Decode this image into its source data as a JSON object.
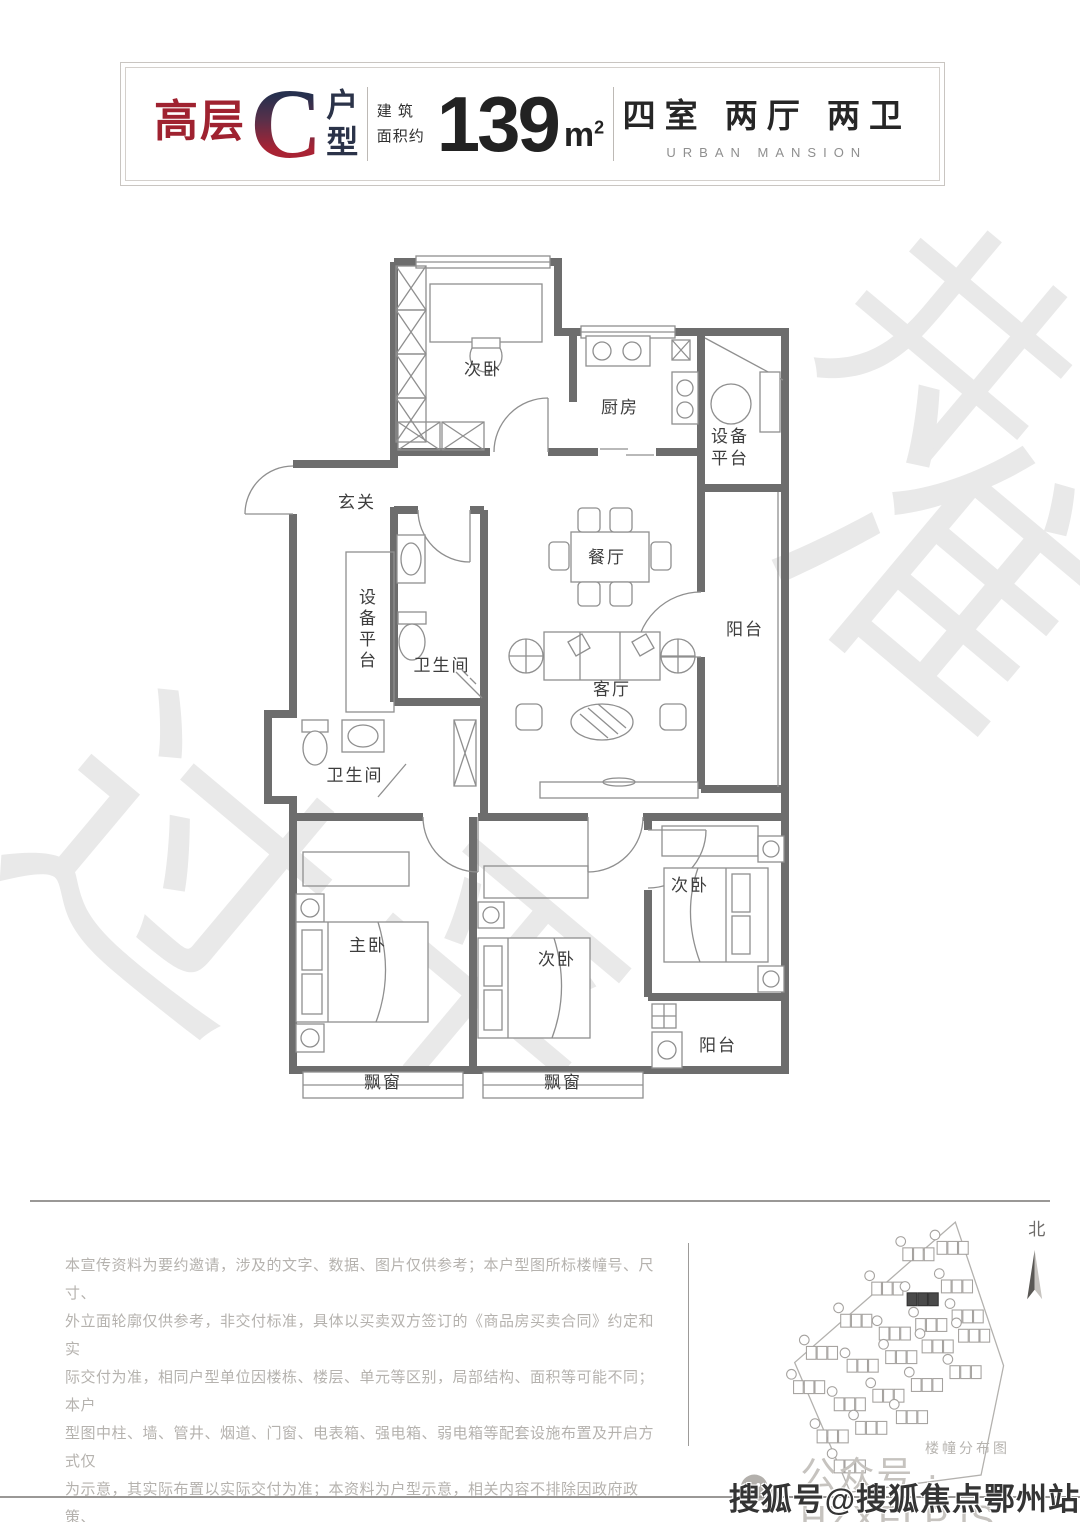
{
  "header": {
    "series": "高层",
    "letter": "C",
    "suffix_top": "户",
    "suffix_bottom": "型",
    "area_label_1": "建 筑",
    "area_label_2": "面积约",
    "area_value": "139",
    "area_unit_base": "m",
    "area_unit_sup": "2",
    "spec": "四室 两厅 两卫",
    "spec_en": "URBAN MANSION"
  },
  "floor_plan": {
    "rooms": [
      {
        "label": "次卧",
        "x": 225,
        "y": 118
      },
      {
        "label": "厨房",
        "x": 362,
        "y": 156
      },
      {
        "label": "设备\n平台",
        "x": 472,
        "y": 196
      },
      {
        "label": "玄关",
        "x": 99,
        "y": 251
      },
      {
        "label": "餐厅",
        "x": 349,
        "y": 306
      },
      {
        "label": "阳台",
        "x": 487,
        "y": 378
      },
      {
        "label": "设备平台",
        "x": 107,
        "y": 378,
        "vertical": true
      },
      {
        "label": "卫生间",
        "x": 184,
        "y": 414
      },
      {
        "label": "客厅",
        "x": 354,
        "y": 438
      },
      {
        "label": "卫生间",
        "x": 97,
        "y": 524
      },
      {
        "label": "主卧",
        "x": 110,
        "y": 694
      },
      {
        "label": "次卧",
        "x": 299,
        "y": 708
      },
      {
        "label": "次卧",
        "x": 432,
        "y": 634
      },
      {
        "label": "阳台",
        "x": 460,
        "y": 794
      },
      {
        "label": "飘窗",
        "x": 125,
        "y": 831
      },
      {
        "label": "飘窗",
        "x": 305,
        "y": 831
      }
    ]
  },
  "disclaimer": {
    "lines": [
      "本宣传资料为要约邀请，涉及的文字、数据、图片仅供参考；本户型图所标楼幢号、尺寸、",
      "外立面轮廓仅供参考，非交付标准，具体以买卖双方签订的《商品房买卖合同》约定和实",
      "际交付为准，相同户型单位因楼栋、楼层、单元等区别，局部结构、面积等可能不同；本户",
      "型图中柱、墙、管井、烟道、门窗、电表箱、强电箱、弱电箱等配套设施布置及开启方式仅",
      "为示意，其实际布置以实际交付为准；本资料为户型示意，相关内容不排除因政府政策、",
      "规定及开发商不可控因素而变化，本公司保留对宣传资料修改的权利，所发布的各项内",
      "容制作时间：2023年7月，有效期1个月。"
    ]
  },
  "site_map": {
    "caption": "楼幢分布图",
    "north_label": "北",
    "polygon": "228,16 273,150 252,252 130,268 78,147",
    "buildings": [
      [
        194,
        46
      ],
      [
        226,
        40
      ],
      [
        165,
        78
      ],
      [
        198,
        88
      ],
      [
        230,
        76
      ],
      [
        136,
        108
      ],
      [
        172,
        120
      ],
      [
        206,
        112
      ],
      [
        240,
        104
      ],
      [
        104,
        138
      ],
      [
        142,
        150
      ],
      [
        178,
        142
      ],
      [
        212,
        132
      ],
      [
        246,
        122
      ],
      [
        92,
        170
      ],
      [
        130,
        186
      ],
      [
        166,
        178
      ],
      [
        202,
        168
      ],
      [
        238,
        156
      ],
      [
        114,
        216
      ],
      [
        150,
        208
      ],
      [
        188,
        198
      ],
      [
        130,
        244
      ]
    ],
    "highlighted_building_index": 3
  },
  "footer": {
    "wechat_label": "公众号 · HZXFLPJS",
    "sohu_watermark": "搜狐号@搜狐焦点鄂州站"
  },
  "watermark": {
    "glyphs": [
      {
        "char": "井",
        "x": 830,
        "y": 235,
        "size": 240
      },
      {
        "char": "准",
        "x": 790,
        "y": 420,
        "size": 300
      },
      {
        "char": "过",
        "x": 20,
        "y": 720,
        "size": 300
      },
      {
        "char": "平",
        "x": 350,
        "y": 860,
        "size": 260
      }
    ]
  }
}
